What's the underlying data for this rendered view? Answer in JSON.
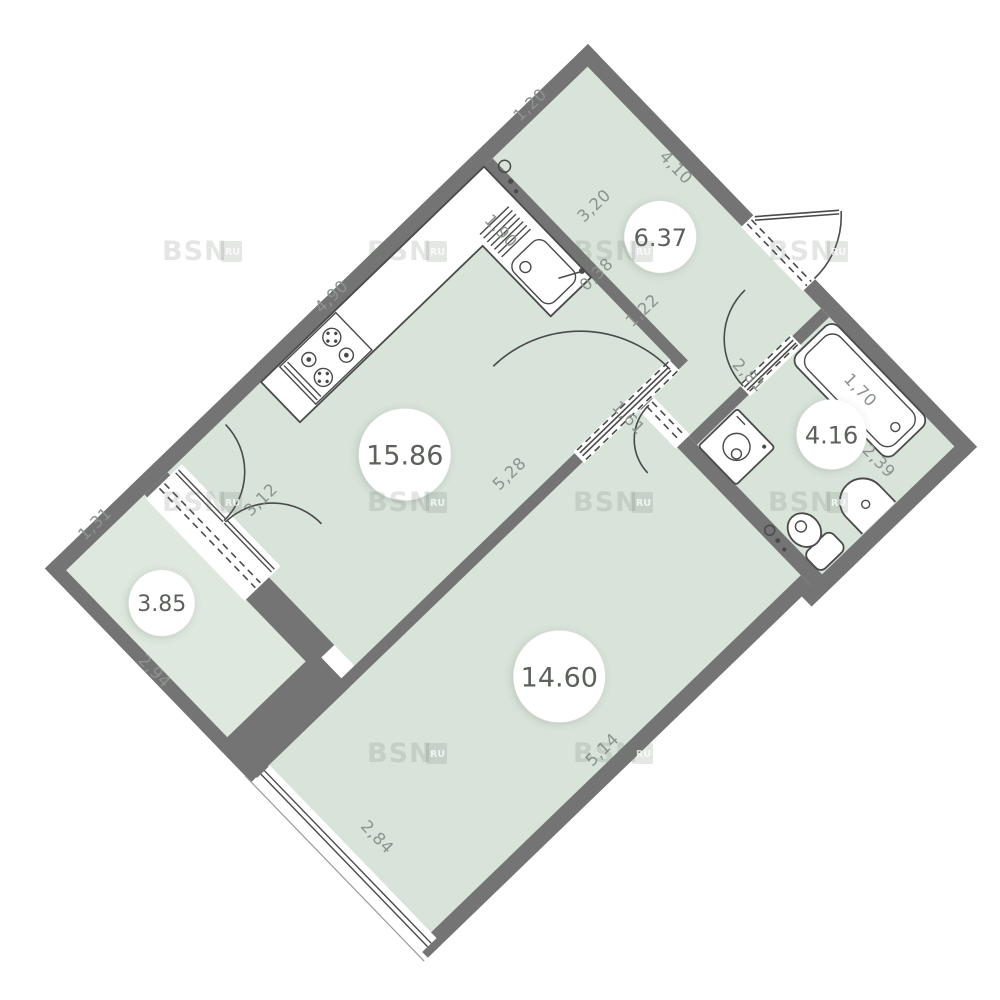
{
  "watermark": {
    "text": "BSN",
    "sub": "RU"
  },
  "rooms": [
    {
      "name": "hallway",
      "area": "6.37"
    },
    {
      "name": "kitchen-living-room",
      "area": "15.86"
    },
    {
      "name": "bathroom",
      "area": "4.16"
    },
    {
      "name": "living-room",
      "area": "14.60"
    },
    {
      "name": "balcony",
      "area": "3.85"
    }
  ],
  "dimensions": [
    {
      "label": "1,20"
    },
    {
      "label": "4,10"
    },
    {
      "label": "3,20"
    },
    {
      "label": "1,90"
    },
    {
      "label": "0,38"
    },
    {
      "label": "1,22"
    },
    {
      "label": "1,61"
    },
    {
      "label": "2,81"
    },
    {
      "label": "1,70"
    },
    {
      "label": "2,39"
    },
    {
      "label": "4,90"
    },
    {
      "label": "5,28"
    },
    {
      "label": "3,12"
    },
    {
      "label": "5,14"
    },
    {
      "label": "2,84"
    },
    {
      "label": "1,31"
    },
    {
      "label": "2,94"
    }
  ],
  "colors": {
    "background": "#ffffff",
    "wall": "#747474",
    "floor": "#d8e3d9",
    "floor_balcony": "#dee8de",
    "dimension_text": "#8d938d",
    "area_text": "#5c615c",
    "fixture_stroke": "#4a4a4a",
    "watermark": "#6f7a71"
  }
}
